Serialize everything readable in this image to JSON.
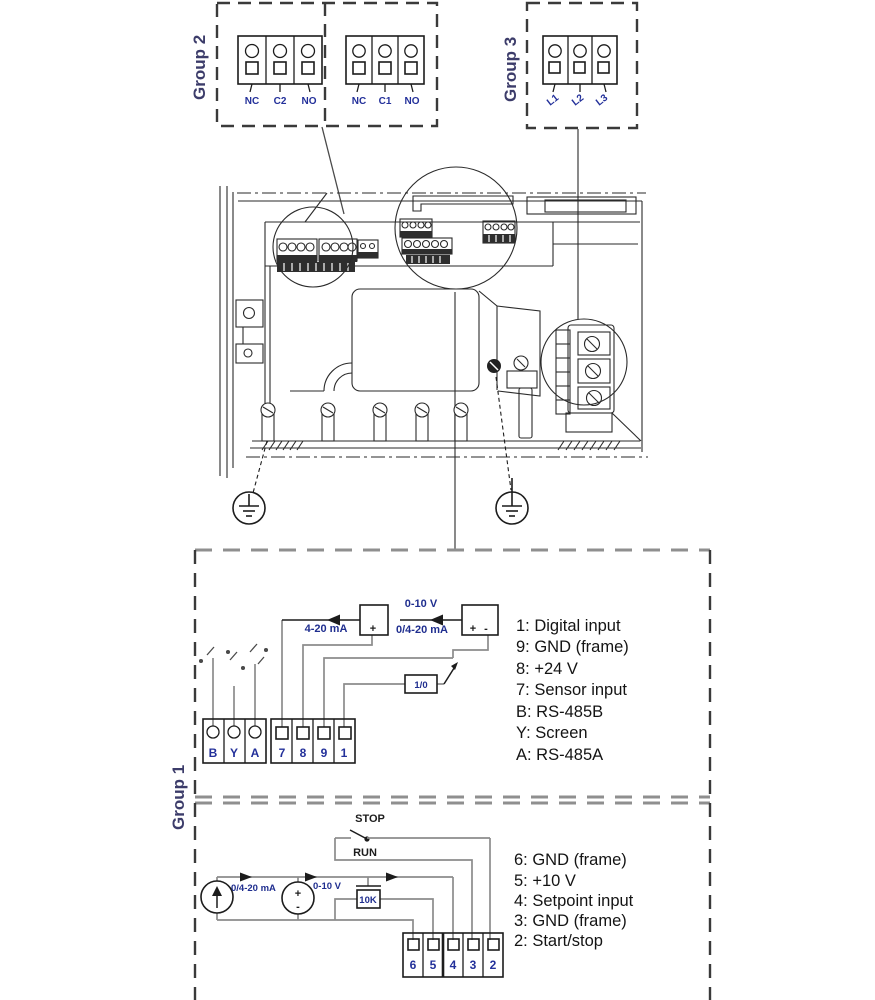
{
  "group2": {
    "label": "Group 2",
    "block_a": [
      "NC",
      "C2",
      "NO"
    ],
    "block_b": [
      "NC",
      "C1",
      "NO"
    ]
  },
  "group3": {
    "label": "Group 3",
    "block": [
      "L1",
      "L2",
      "L3"
    ]
  },
  "group1": {
    "label": "Group 1",
    "upper": {
      "labels": {
        "current": "4-20 mA",
        "voltage": "0-10 V",
        "combo": "0/4-20 mA",
        "switch": "1/0",
        "plus": "+",
        "minus": "-"
      },
      "comm_terminals": [
        "B",
        "Y",
        "A"
      ],
      "io_terminals": [
        "7",
        "8",
        "9",
        "1"
      ],
      "legend": [
        "1: Digital input",
        "9: GND (frame)",
        "8: +24 V",
        "7: Sensor input",
        "B: RS-485B",
        "Y: Screen",
        "A: RS-485A"
      ]
    },
    "lower": {
      "labels": {
        "stop": "STOP",
        "run": "RUN",
        "current": "0/4-20 mA",
        "voltage": "0-10 V",
        "pot": "10K",
        "plus": "+",
        "minus": "-"
      },
      "terminals": [
        "6",
        "5",
        "4",
        "3",
        "2"
      ],
      "legend": [
        "6: GND (frame)",
        "5: +10 V",
        "4: Setpoint input",
        "3: GND (frame)",
        "2: Start/stop"
      ]
    }
  }
}
